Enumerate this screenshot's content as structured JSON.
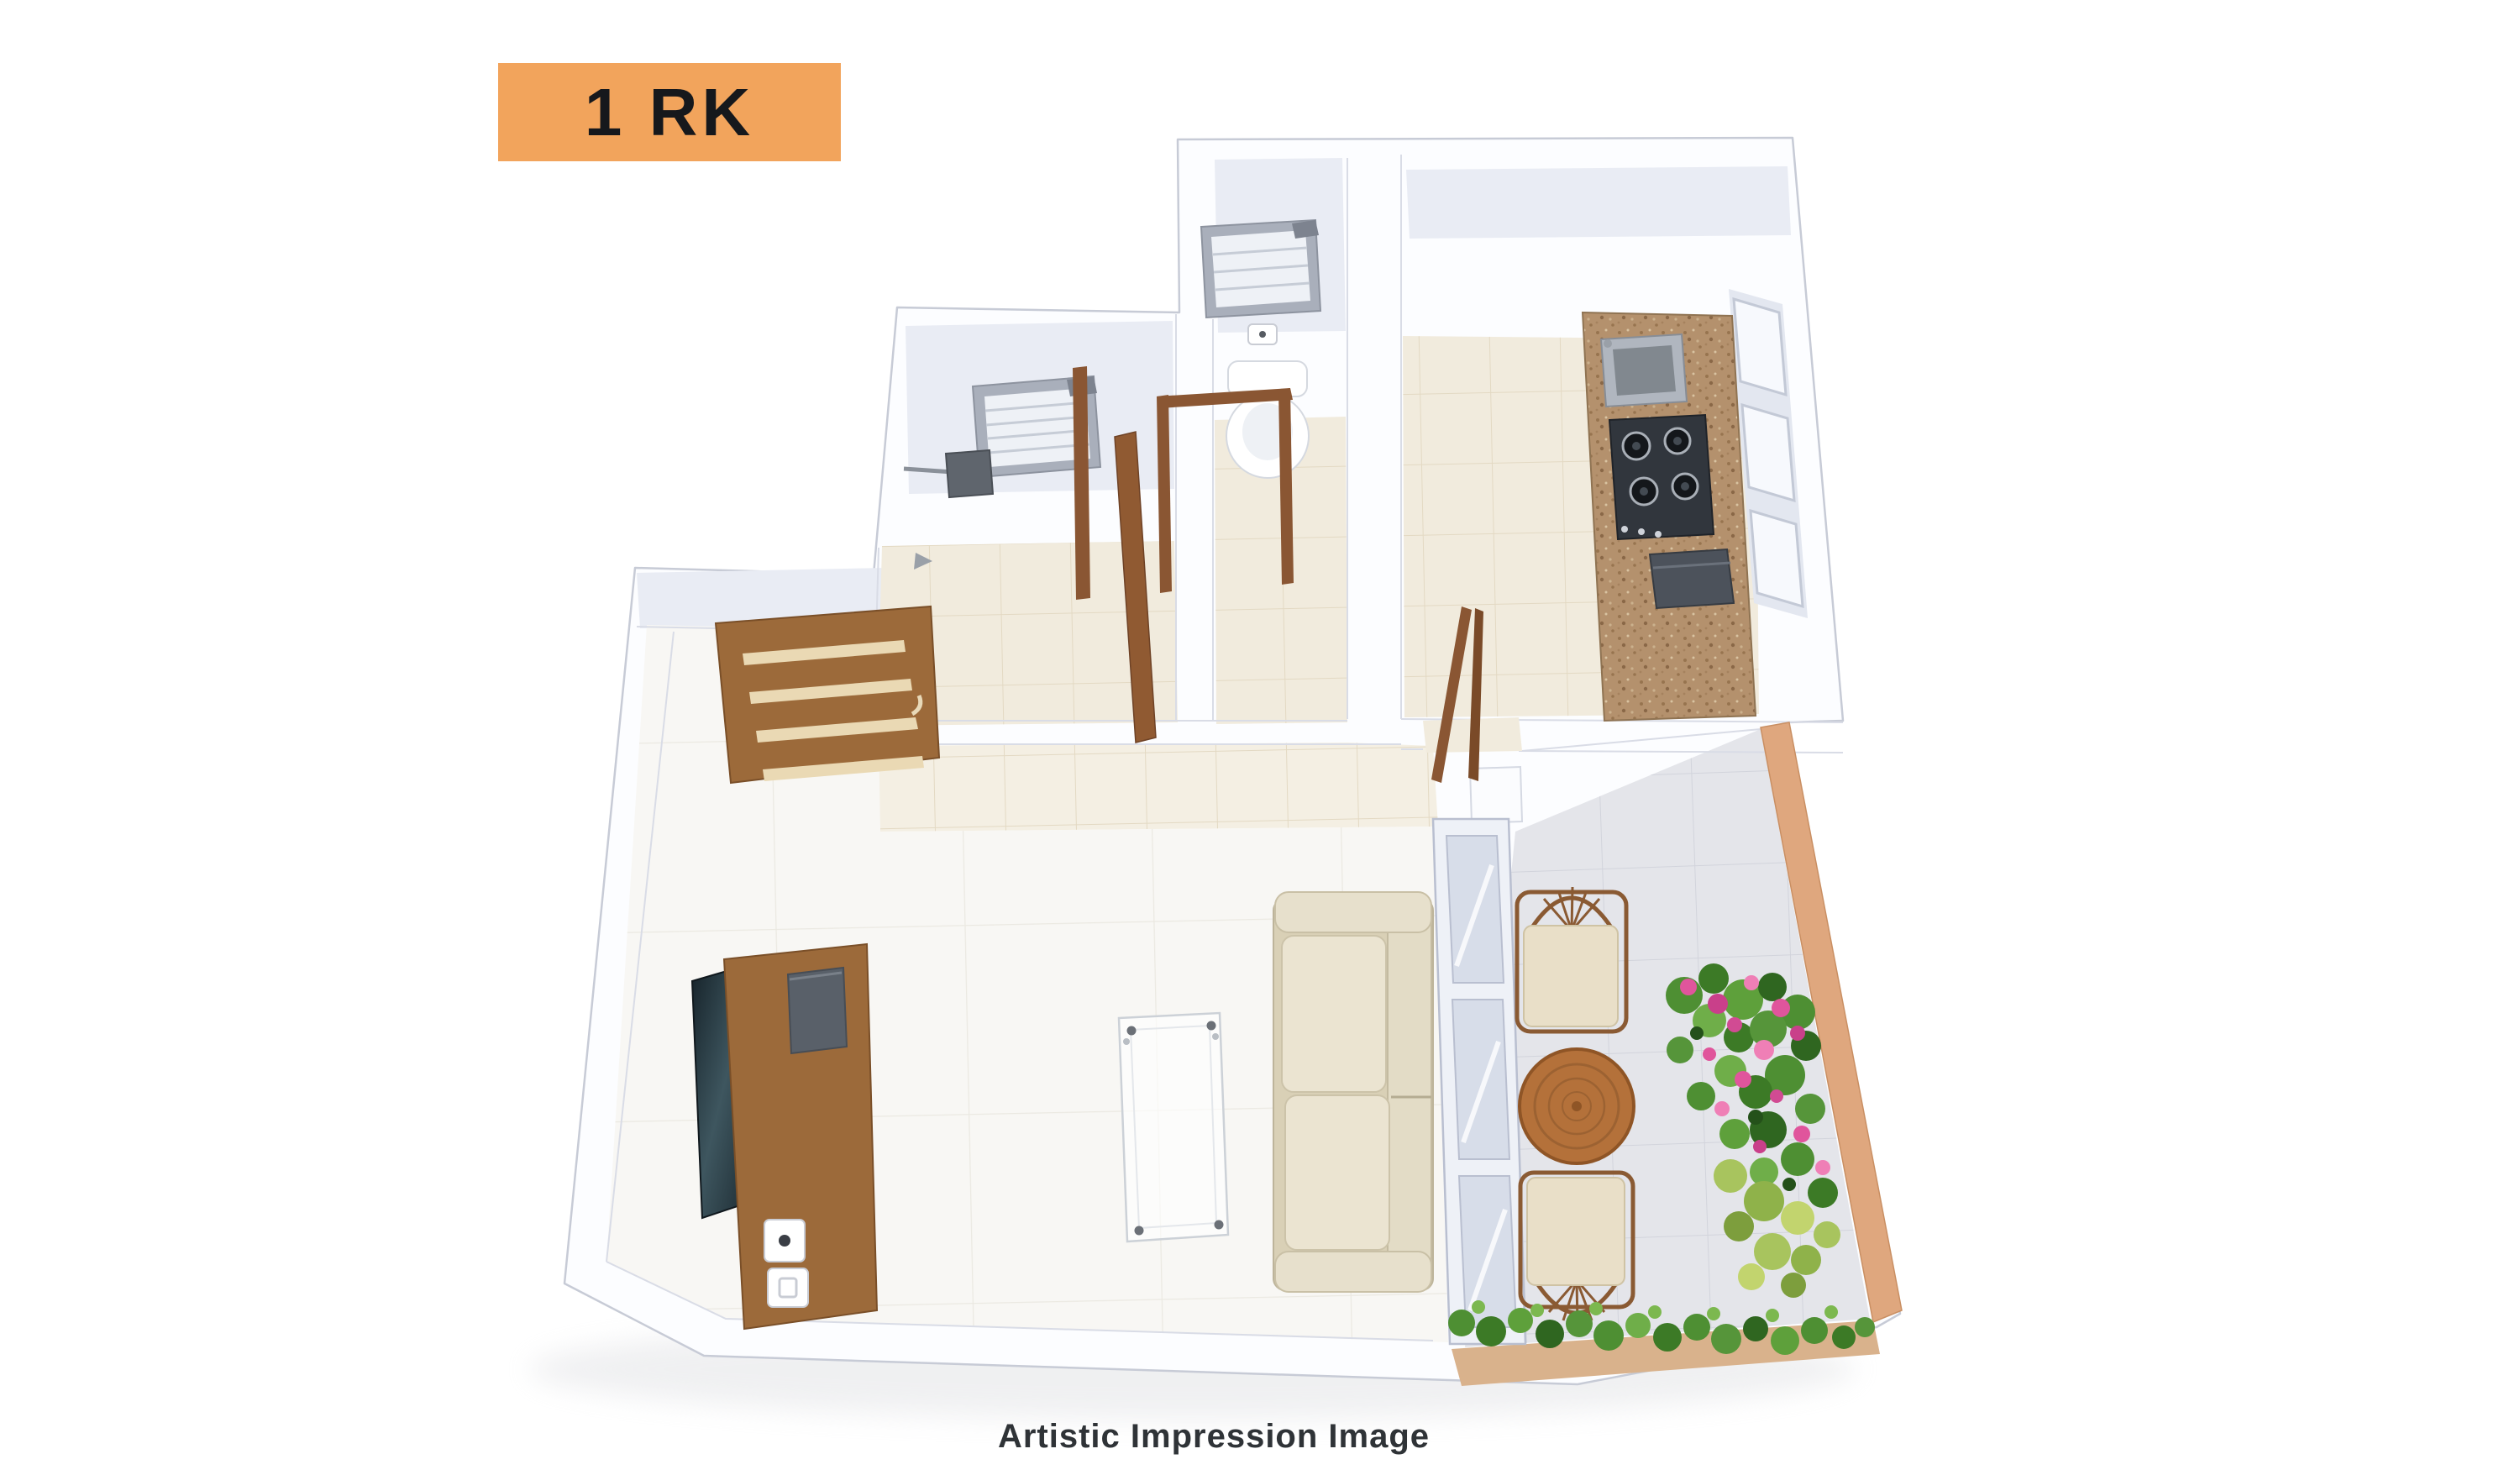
{
  "page": {
    "background": "#FFFFFF"
  },
  "plan_label": {
    "text": "1 RK"
  },
  "caption": {
    "text": "Artistic Impression Image"
  },
  "colors": {
    "page_bg": "#FFFFFF",
    "accent_orange": "#F2A45C",
    "label_text": "#16181C",
    "caption_text": "#2F3337",
    "wall_white": "#FCFDFF",
    "wall_shade": "#E9ECF4",
    "floor_cream": "#F1EBDD",
    "floor_white": "#F8F7F4",
    "floor_gray": "#E4E5EA",
    "wood_brown": "#9C6A3A",
    "door_wood": "#8A5633",
    "granite_counter": "#B4916D",
    "sofa_beige": "#E7E0CC",
    "balcony_wall_terracotta": "#DFA77E",
    "table_wood": "#B4713A",
    "plant_green": "#4E8F33",
    "flower_pink": "#E0559C",
    "glass_blue": "#D7DDE9"
  }
}
